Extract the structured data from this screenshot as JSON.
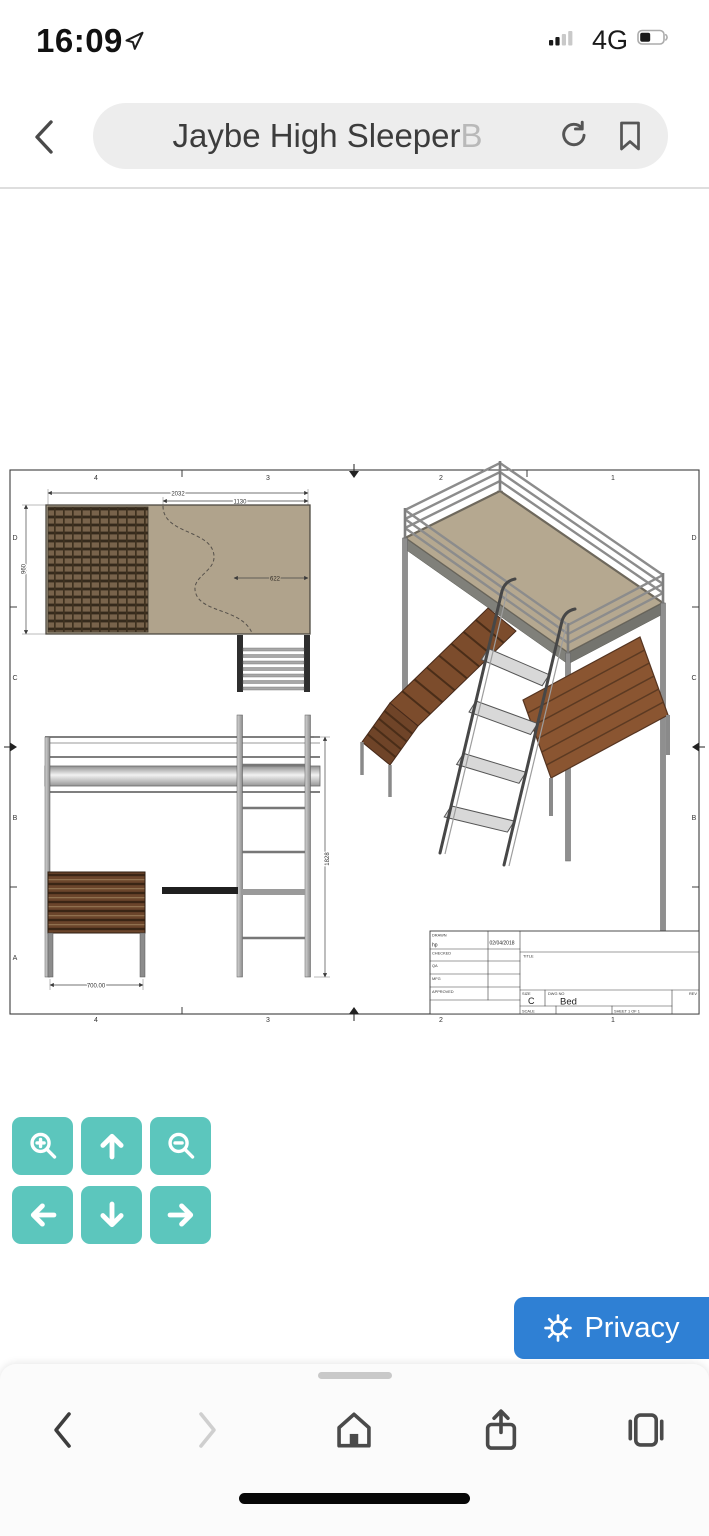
{
  "status_bar": {
    "time": "16:09",
    "network_label": "4G"
  },
  "browser": {
    "address_text": "Jaybe High Sleeper",
    "address_text_faded": "B"
  },
  "drawing": {
    "zone_columns": [
      "4",
      "3",
      "2",
      "1"
    ],
    "zone_rows": [
      "D",
      "C",
      "B",
      "A"
    ],
    "plan_view": {
      "dim_total_width": "2032",
      "dim_partial_width": "1130",
      "dim_depth": "960",
      "dim_cutout": "622"
    },
    "front_view": {
      "dim_chest_width": "700.00",
      "dim_height": "1828"
    },
    "title_block": {
      "drawn_label": "DRAWN",
      "drawn_value": "hp",
      "drawn_date": "02/04/2018",
      "checked_label": "CHECKED",
      "qa_label": "QA",
      "mfg_label": "MFG",
      "approved_label": "APPROVED",
      "title_label": "TITLE",
      "size_label": "SIZE",
      "size_value": "C",
      "dwg_no_label": "DWG NO",
      "dwg_no_value": "Bed",
      "rev_label": "REV",
      "scale_label": "SCALE",
      "sheet_label": "SHEET 1  OF 1"
    }
  },
  "viewer_controls": {
    "color": "#5cc6bd",
    "buttons": [
      {
        "icon": "zoom-in"
      },
      {
        "icon": "pan-up"
      },
      {
        "icon": "zoom-out"
      },
      {
        "icon": "pan-left"
      },
      {
        "icon": "pan-down"
      },
      {
        "icon": "pan-right"
      }
    ]
  },
  "privacy": {
    "label": "Privacy",
    "color": "#2f80d4"
  },
  "toolbar": {
    "icons": [
      "back",
      "forward",
      "home",
      "share",
      "tabs"
    ]
  }
}
